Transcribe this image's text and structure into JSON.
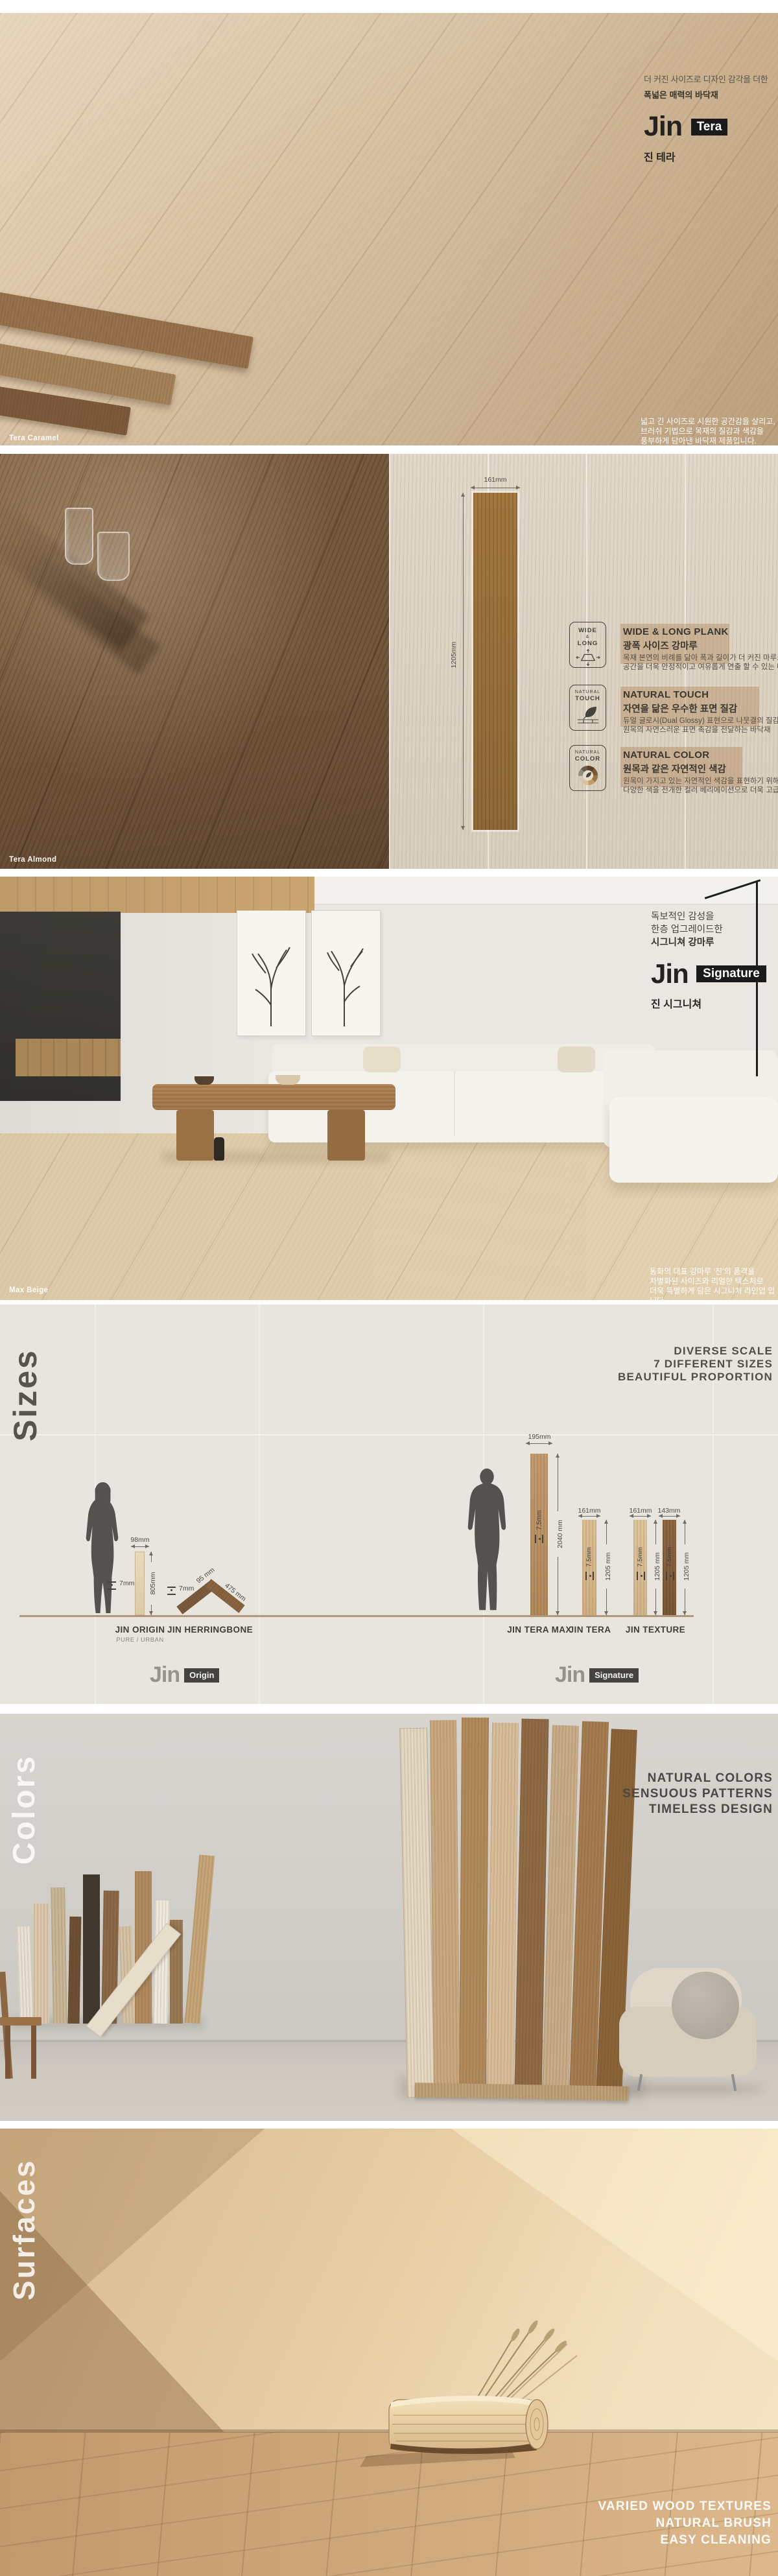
{
  "hero_tera": {
    "intro_line1": "더 커진 사이즈로 디자인 감각을 더한",
    "intro_line2": "폭넓은 매력의 바닥재",
    "logo": "Jin",
    "badge": "Tera",
    "korean_name": "진 테라",
    "swatch_label": "Tera Caramel",
    "desc_line1": "넓고 긴 사이즈로 시원한 공간감을 살리고,",
    "desc_line2": "브러쉬 기법으로 목재의 질감과 색감을",
    "desc_line3": "풍부하게 담아낸 바닥재 제품입니다."
  },
  "plank_spec": {
    "swatch_label": "Tera Almond",
    "width_dim": "161mm",
    "length_dim": "1205mm",
    "items": [
      {
        "icon_top": "WIDE",
        "icon_mid": "&",
        "icon_bottom": "LONG",
        "title": "WIDE & LONG PLANK",
        "subtitle": "광폭 사이즈 강마루",
        "body1": "목재 본연의 비례를 닮아 폭과 길이가 더 커진 마루로",
        "body2": "공간을 더욱 안정적이고 여유롭게 연출 할 수 있는 바닥재"
      },
      {
        "icon_top": "NATURAL",
        "icon_bottom": "TOUCH",
        "title": "NATURAL TOUCH",
        "subtitle": "자연을 닮은 우수한 표면 질감",
        "body1": "듀얼 글로시(Dual Glossy) 표현으로 나뭇결의 질감을 세밀하게 표현하여,",
        "body2": "원목의 자연스러운 표면 촉감을 전달하는 바닥재"
      },
      {
        "icon_top": "NATURAL",
        "icon_bottom": "COLOR",
        "title": "NATURAL COLOR",
        "subtitle": "원목과 같은 자연적인 색감",
        "body1": "원목이 가지고 있는 자연적인 색감을 표현하기 위해",
        "body2": "다양한 색을 전개한 컬러 베리에이션으로 더욱 고급스러워진 패턴"
      }
    ]
  },
  "hero_signature": {
    "intro_line1": "독보적인 감성을",
    "intro_line2": "한층 업그레이드한",
    "intro_line3": "시그니쳐 강마루",
    "logo": "Jin",
    "badge": "Signature",
    "korean_name": "진 시그니쳐",
    "swatch_label": "Max Beige",
    "desc_line1": "동화의 대표 강마루 ‘진’의 품격을",
    "desc_line2": "차별화된 사이즈와 리얼한 텍스처로",
    "desc_line3": "더욱 특별하게 담은 시그니처 라인업 입니다."
  },
  "sizes": {
    "section_label": "Sizes",
    "heading": [
      "DIVERSE SCALE",
      "7 DIFFERENT SIZES",
      "BEAUTIFUL PROPORTION"
    ],
    "origin_logo": {
      "text": "Jin",
      "badge": "Origin"
    },
    "signature_logo": {
      "text": "Jin",
      "badge": "Signature"
    },
    "products": [
      {
        "name": "JIN ORIGIN",
        "variants": "PURE / URBAN",
        "width": "98mm",
        "length": "805mm",
        "thickness": "7mm"
      },
      {
        "name": "JIN HERRINGBONE",
        "width": "95 mm",
        "length": "475 mm",
        "thickness": "7mm"
      },
      {
        "name": "JIN TERA MAX",
        "width": "195mm",
        "length": "2040 mm",
        "thickness": "7.5mm"
      },
      {
        "name": "JIN TERA",
        "width": "161mm",
        "length": "1205 mm",
        "thickness": "7.5mm"
      },
      {
        "name": "JIN TEXTURE",
        "width_a": "161mm",
        "width_b": "143mm",
        "length": "1205 mm",
        "thickness": "7.5mm"
      }
    ]
  },
  "colors": {
    "section_label": "Colors",
    "heading": [
      "NATURAL COLORS",
      "SENSUOUS PATTERNS",
      "TIMELESS DESIGN"
    ]
  },
  "surfaces": {
    "section_label": "Surfaces",
    "heading": [
      "VARIED WOOD TEXTURES",
      "NATURAL BRUSH",
      "EASY CLEANING"
    ]
  },
  "palette": {
    "badge_black": "#1a1a1a",
    "text_dark": "#3b372f",
    "heading_gray": "#514e49",
    "highlight_band": "rgba(171,124,76,0.38)",
    "wood_light": "#d8c3a6",
    "wood_mid": "#a87c4e",
    "wood_dark": "#7a5c3f",
    "section_beige": "#e8e4de",
    "white": "#ffffff"
  }
}
